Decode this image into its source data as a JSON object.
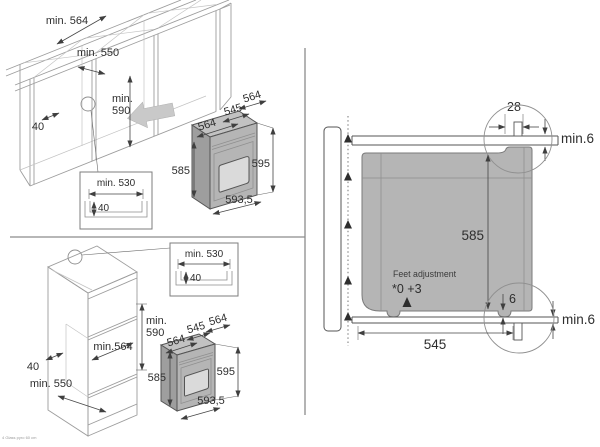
{
  "caption": "4 Glass pyro 60 cm",
  "colors": {
    "oven_body": "#b5b5b5",
    "oven_top_face": "#c2c2c2",
    "oven_side_face": "#9e9e9e",
    "oven_window": "#dadada",
    "insert_arrow": "#c9c9c9",
    "line": "#454545",
    "wireframe": "#9d9d9d",
    "background": "#ffffff"
  },
  "base_cabinet": {
    "niche_width": "min. 564",
    "niche_depth": "min. 550",
    "niche_height_line1": "min.",
    "niche_height_line2": "590",
    "rail_width": "40",
    "detail": {
      "cutout_width": "min. 530",
      "cutout_height": "40"
    },
    "oven": {
      "width_top": "564",
      "depth": "545",
      "width_front": "564",
      "height_front": "585",
      "height_side": "595",
      "width_bottom": "593,5"
    }
  },
  "tall_cabinet": {
    "niche_height_line1": "min.",
    "niche_height_line2": "590",
    "niche_width": "min.564",
    "rail_width": "40",
    "niche_depth": "min. 550",
    "detail": {
      "cutout_width": "min. 530",
      "cutout_height": "40"
    },
    "oven": {
      "width_top": "564",
      "depth": "545",
      "width_front": "564",
      "height_front": "585",
      "height_side": "595",
      "width_bottom": "593,5"
    }
  },
  "side_section": {
    "rear_gap": "28",
    "top_clearance": "min.6",
    "height": "585",
    "feet_note": "Feet adjustment",
    "feet_range": "*0 +3",
    "bottom_gap": "6",
    "bottom_clearance": "min.6",
    "depth": "545"
  }
}
